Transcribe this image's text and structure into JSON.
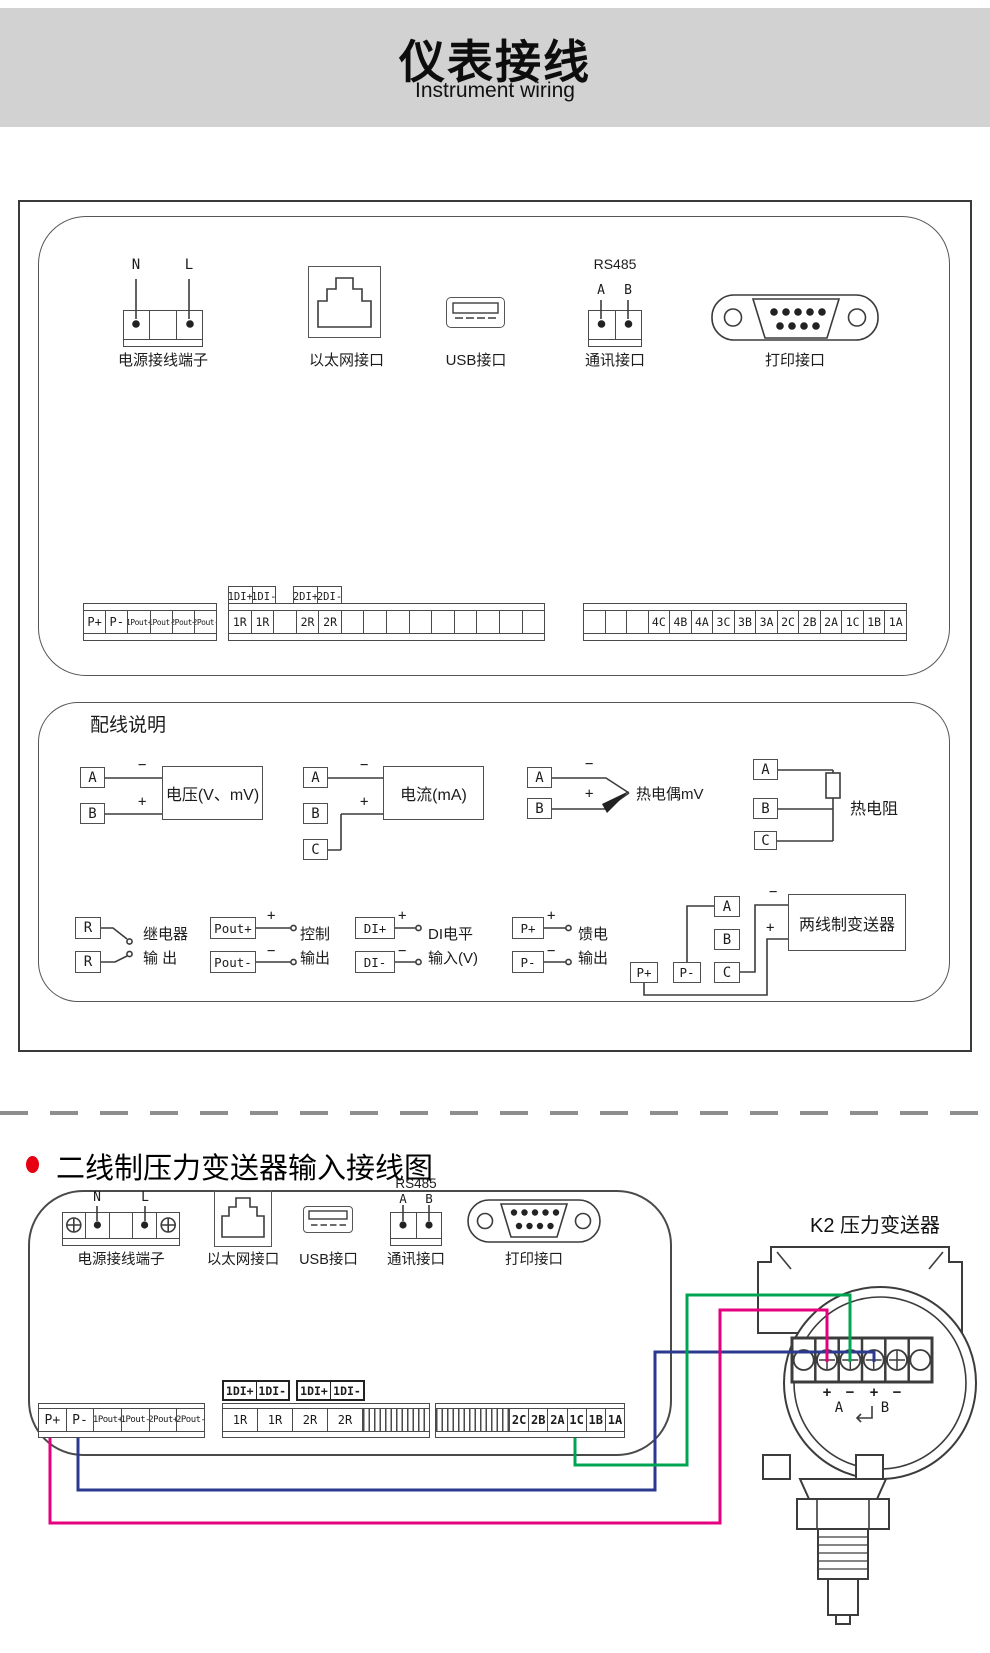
{
  "header": {
    "title": "仪表接线",
    "subtitle": "Instrument wiring"
  },
  "top_panel": {
    "power": {
      "n": "N",
      "l": "L",
      "label": "电源接线端子"
    },
    "ethernet": {
      "label": "以太网接口"
    },
    "usb": {
      "label": "USB接口"
    },
    "rs485": {
      "title": "RS485",
      "a": "A",
      "b": "B",
      "label": "通讯接口"
    },
    "printer": {
      "label": "打印接口"
    },
    "di_box1": [
      "1DI+",
      "1DI-"
    ],
    "di_box2": [
      "2DI+",
      "2DI-"
    ],
    "strip_left": [
      "P+",
      "P-",
      "1Pout+",
      "1Pout-",
      "2Pout+",
      "2Pout-"
    ],
    "strip_middle": [
      "1R",
      "1R",
      "",
      "2R",
      "2R"
    ],
    "strip_right": [
      "4C",
      "4B",
      "4A",
      "3C",
      "3B",
      "3A",
      "2C",
      "2B",
      "2A",
      "1C",
      "1B",
      "1A"
    ]
  },
  "wiring": {
    "title": "配线说明",
    "voltage": {
      "a": "A",
      "b": "B",
      "minus": "−",
      "plus": "+",
      "label": "电压(V、mV)"
    },
    "current": {
      "a": "A",
      "b": "B",
      "c": "C",
      "minus": "−",
      "plus": "+",
      "label": "电流(mA)"
    },
    "thermocouple": {
      "a": "A",
      "b": "B",
      "minus": "−",
      "plus": "+",
      "label": "热电偶mV"
    },
    "rtd": {
      "a": "A",
      "b": "B",
      "c": "C",
      "label": "热电阻"
    },
    "relay": {
      "r1": "R",
      "r2": "R",
      "line1": "继电器",
      "line2": "输 出"
    },
    "control": {
      "t1": "Pout+",
      "t2": "Pout-",
      "plus": "+",
      "minus": "−",
      "line1": "控制",
      "line2": "输出"
    },
    "di": {
      "t1": "DI+",
      "t2": "DI-",
      "plus": "+",
      "minus": "−",
      "line1": "DI电平",
      "line2": "输入(V)"
    },
    "feed": {
      "t1": "P+",
      "t2": "P-",
      "plus": "+",
      "minus": "−",
      "line1": "馈电",
      "line2": "输出"
    },
    "transmitter": {
      "a": "A",
      "b": "B",
      "c": "C",
      "p1": "P+",
      "p2": "P-",
      "minus": "−",
      "plus": "+",
      "label": "两线制变送器"
    }
  },
  "bottom": {
    "heading": "二线制压力变送器输入接线图",
    "power": {
      "n": "N",
      "l": "L",
      "label": "电源接线端子"
    },
    "ethernet": {
      "label": "以太网接口"
    },
    "usb": {
      "label": "USB接口"
    },
    "rs485": {
      "title": "RS485",
      "a": "A",
      "b": "B",
      "label": "通讯接口"
    },
    "printer": {
      "label": "打印接口"
    },
    "di_box1": [
      "1DI+",
      "1DI-"
    ],
    "di_box2": [
      "1DI+",
      "1DI-"
    ],
    "strip_left": [
      "P+",
      "P-",
      "1Pout+",
      "1Pout-",
      "2Pout+",
      "2Pout-"
    ],
    "strip_middle": [
      "1R",
      "1R",
      "2R",
      "2R"
    ],
    "strip_right": [
      "2C",
      "2B",
      "2A",
      "1C",
      "1B",
      "1A"
    ],
    "transmitter": {
      "title": "K2 压力变送器",
      "signs": [
        "+",
        "−",
        "+",
        "−"
      ],
      "groups": [
        "A",
        "B"
      ]
    }
  },
  "colors": {
    "wire_green": "#00A551",
    "wire_magenta": "#E4007F",
    "wire_blue": "#2B3A8F",
    "bullet_red": "#E60012"
  }
}
